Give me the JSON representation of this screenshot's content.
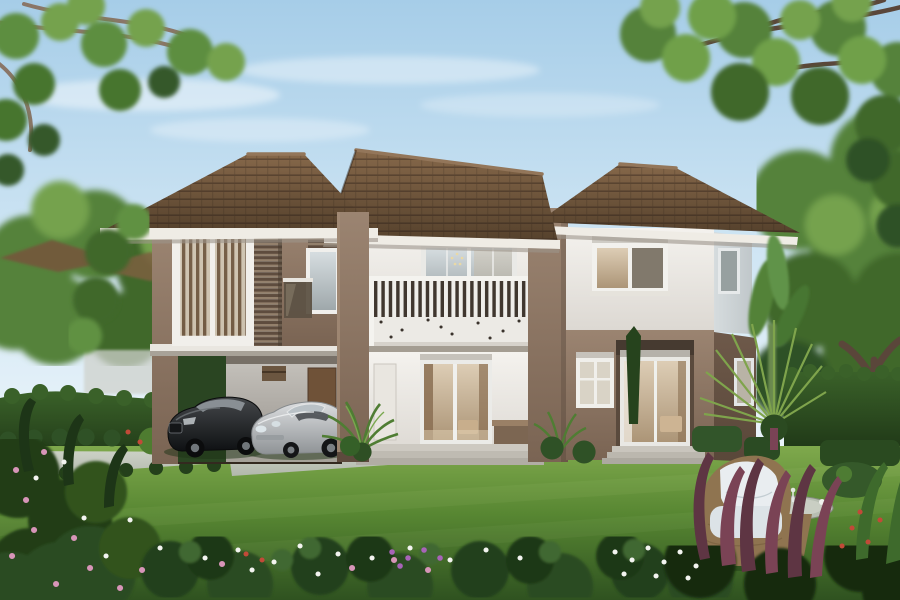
{
  "meta": {
    "type": "architectural-rendering",
    "title": "Two-storey contemporary house — exterior front view",
    "description": "Photorealistic 3D rendering of a two-storey brown-and-cream house with hipped tile roof, second-floor slatted balcony, carport sheltering a black sedan and a silver convertible, manicured front lawn, flower beds, clipped hedges, ornamental palms, rattan garden furniture and overhanging tree canopies under a pale blue sky.",
    "time_of_day": "daytime",
    "text_content": "none"
  },
  "objects": [
    {
      "name": "house",
      "label": "two-storey house with hipped brown tile roof"
    },
    {
      "name": "balcony",
      "label": "slatted-rail balcony over the entry"
    },
    {
      "name": "carport",
      "label": "carport under the left wing"
    },
    {
      "name": "car-black",
      "label": "black luxury sedan"
    },
    {
      "name": "car-silver",
      "label": "silver convertible"
    },
    {
      "name": "lawn",
      "label": "front lawn"
    },
    {
      "name": "flower-beds",
      "label": "foreground flower beds"
    },
    {
      "name": "hedges",
      "label": "clipped hedges"
    },
    {
      "name": "palms",
      "label": "ornamental palms"
    },
    {
      "name": "armchair",
      "label": "rattan armchair with white cushions"
    },
    {
      "name": "side-table",
      "label": "rattan side table with glass top"
    },
    {
      "name": "trees",
      "label": "overhanging tree canopies"
    }
  ],
  "palette": {
    "sky": {
      "top": "#a6cde8",
      "mid": "#cde4f3",
      "horizon": "#eef6fb"
    },
    "cloud": "#ffffff",
    "roof": {
      "light": "#86684a",
      "dark": "#55412c",
      "ridge": "#93765a",
      "fascia": "#efece5"
    },
    "walls": {
      "white_hi": "#f4f2ee",
      "white_lo": "#dcd8d2",
      "side_hi": "#d6dcde",
      "side_lo": "#c0c7ca",
      "brown_hi": "#9b8471",
      "brown_lo": "#7a6453",
      "brown_side_hi": "#6e594a",
      "brown_side_lo": "#594739",
      "soffit": "#4e3f33",
      "gray_hi": "#c9c6c0",
      "gray_lo": "#95908a"
    },
    "glass": {
      "cool_hi": "#d6dde0",
      "cool_lo": "#9fa8ab",
      "warm_hi": "#ddcdb5",
      "warm_lo": "#ac9577",
      "frame": "#f0efec",
      "dark": "#81796c",
      "curtain": "#8a6f52"
    },
    "balcony": {
      "slat": "#efeeea",
      "gap": "#3e362e",
      "band": "#eceae5",
      "rail": "#f4f3ef"
    },
    "lawn": {
      "light": "#7fa94c",
      "mid": "#578632",
      "dark": "#2f5220"
    },
    "greens": {
      "tree_hi": "#74a24e",
      "tree_mid": "#55823a",
      "tree_lo": "#3f6829",
      "tree_deep": "#2f5126",
      "hedge_hi": "#3a6129",
      "hedge_lo": "#1b3114",
      "bed": "#24401b",
      "bed_dark": "#16290f"
    },
    "drive": {
      "hi": "#ccd1c6",
      "lo": "#b2b8ac"
    },
    "cars": {
      "black_hi": "#45484b",
      "black_lo": "#0f1113",
      "silver_hi": "#dcdee0",
      "silver_lo": "#8f9396"
    },
    "furniture": {
      "wicker": "#8f7450",
      "wicker_dark": "#6f5838",
      "cushion": "#e9edf0",
      "table_top": "#b7beb2"
    },
    "plants": {
      "palm": "#4f7d33",
      "palm_hi": "#79a84e",
      "cordyline": "#5e3543",
      "cordyline_hi": "#7a4355",
      "banana": "#538238",
      "trunk": "#5a463a",
      "branch": "#8a7668"
    },
    "flowers": {
      "white": "#f3f4f0",
      "pink": "#d795b8",
      "purple": "#a864b8",
      "red": "#c24a38"
    }
  }
}
